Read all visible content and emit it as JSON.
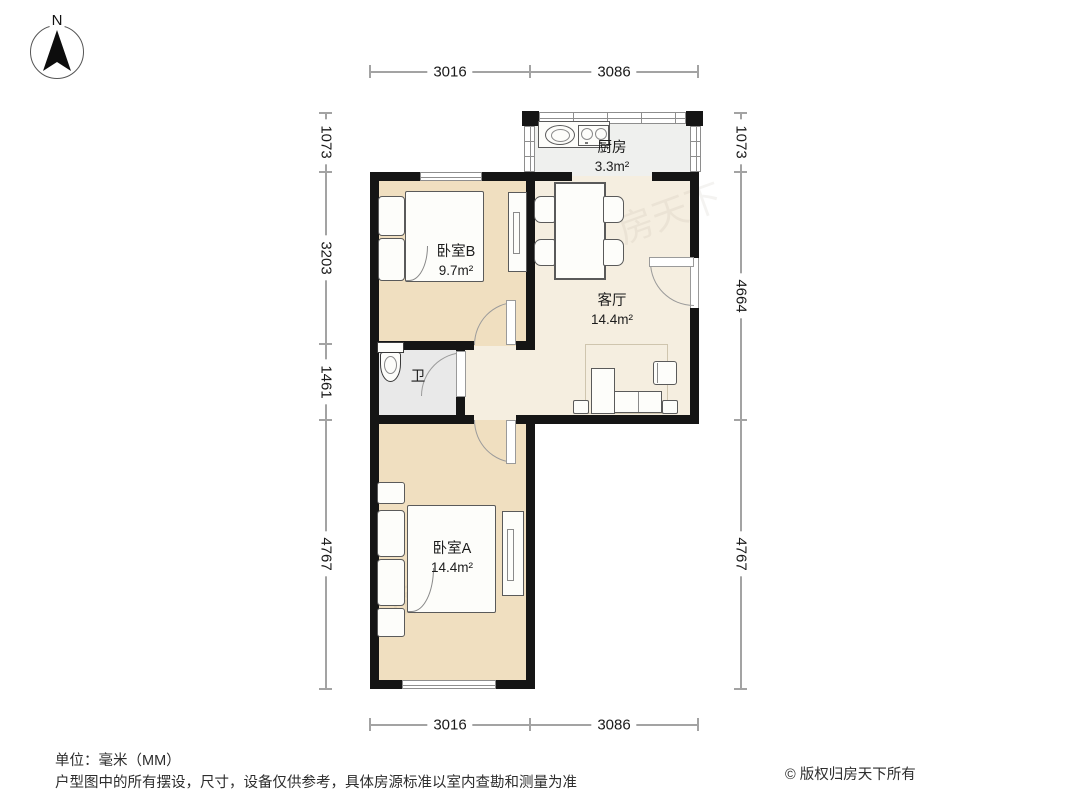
{
  "compass": {
    "north_label": "N"
  },
  "rooms": {
    "kitchen": {
      "name": "厨房",
      "area": "3.3m²"
    },
    "bedroomB": {
      "name": "卧室B",
      "area": "9.7m²"
    },
    "living": {
      "name": "客厅",
      "area": "14.4m²"
    },
    "bath": {
      "name": "卫"
    },
    "bedroomA": {
      "name": "卧室A",
      "area": "14.4m²"
    }
  },
  "dimensions": {
    "unit": "mm",
    "top": [
      "3016",
      "3086"
    ],
    "bottom": [
      "3016",
      "3086"
    ],
    "left": [
      "1073",
      "3203",
      "1461",
      "4767"
    ],
    "right": [
      "1073",
      "4664",
      "4767"
    ]
  },
  "watermark": "房天下",
  "footer": {
    "unit_note": "单位：毫米（MM）",
    "disclaimer": "户型图中的所有摆设，尺寸，设备仅供参考，具体房源标准以室内查勘和测量为准",
    "copyright": "© 版权归房天下所有"
  },
  "colors": {
    "wall": "#151515",
    "bedroom_floor": "#f0dfc0",
    "living_floor": "#f5eee0",
    "kitchen_floor": "#eff0ee",
    "bath_floor": "#e9e9e9",
    "dim_line": "#a3a3a3"
  }
}
